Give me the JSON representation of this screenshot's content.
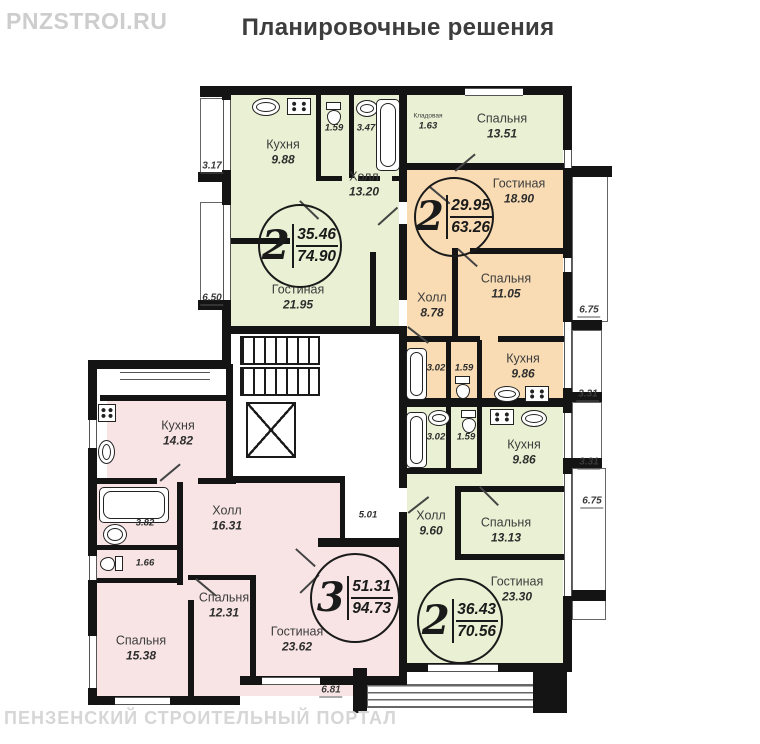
{
  "title": "Планировочные решения",
  "watermarks": {
    "top_left": "PNZSTROI.RU",
    "bottom_left": "ПЕНЗЕНСКИЙ СТРОИТЕЛЬНЫЙ ПОРТАЛ"
  },
  "legend_colors": {
    "two_room_green": "#eaf0d3",
    "two_room_orange": "#f9dcb4",
    "three_room_pink": "#f8e4e4",
    "walls": "#141414"
  },
  "apartments": [
    {
      "rooms_count": "2",
      "living_area": "35.46",
      "total_area": "74.90",
      "rooms": {
        "kitchen": {
          "name": "Кухня",
          "area": "9.88"
        },
        "hall": {
          "name": "Холл",
          "area": "13.20"
        },
        "living": {
          "name": "Гостиная",
          "area": "21.95"
        },
        "bedroom": {
          "name": "Спальня",
          "area": "13.51"
        },
        "storage": {
          "name": "Кладовая",
          "area": "1.63"
        },
        "wc": {
          "area": "1.59"
        },
        "bath": {
          "area": "3.47"
        }
      }
    },
    {
      "rooms_count": "2",
      "living_area": "29.95",
      "total_area": "63.26",
      "rooms": {
        "living": {
          "name": "Гостиная",
          "area": "18.90"
        },
        "bedroom": {
          "name": "Спальня",
          "area": "11.05"
        },
        "hall": {
          "name": "Холл",
          "area": "8.78"
        },
        "bath": {
          "area": "3.02"
        },
        "wc": {
          "area": "1.59"
        },
        "kitchen": {
          "name": "Кухня",
          "area": "9.86"
        }
      }
    },
    {
      "rooms_count": "2",
      "living_area": "36.43",
      "total_area": "70.56",
      "rooms": {
        "bath": {
          "area": "3.02"
        },
        "wc": {
          "area": "1.59"
        },
        "kitchen": {
          "name": "Кухня",
          "area": "9.86"
        },
        "hall": {
          "name": "Холл",
          "area": "9.60"
        },
        "bedroom": {
          "name": "Спальня",
          "area": "13.13"
        },
        "living": {
          "name": "Гостиная",
          "area": "23.30"
        }
      }
    },
    {
      "rooms_count": "3",
      "living_area": "51.31",
      "total_area": "94.73",
      "rooms": {
        "kitchen": {
          "name": "Кухня",
          "area": "14.82"
        },
        "bath": {
          "area": "3.82"
        },
        "wc": {
          "area": "1.66"
        },
        "hall": {
          "name": "Холл",
          "area": "16.31"
        },
        "bedroom2": {
          "name": "Спальня",
          "area": "12.31"
        },
        "bedroom1": {
          "name": "Спальня",
          "area": "15.38"
        },
        "living": {
          "name": "Гостиная",
          "area": "23.62"
        }
      }
    }
  ],
  "common": {
    "corridor_area": "5.01"
  },
  "dimensions": {
    "left_top": "3.17",
    "left_mid": "6.50",
    "right_1": "6.75",
    "right_2": "3.31",
    "right_3": "3.31",
    "right_4": "6.75",
    "bottom": "6.81"
  }
}
